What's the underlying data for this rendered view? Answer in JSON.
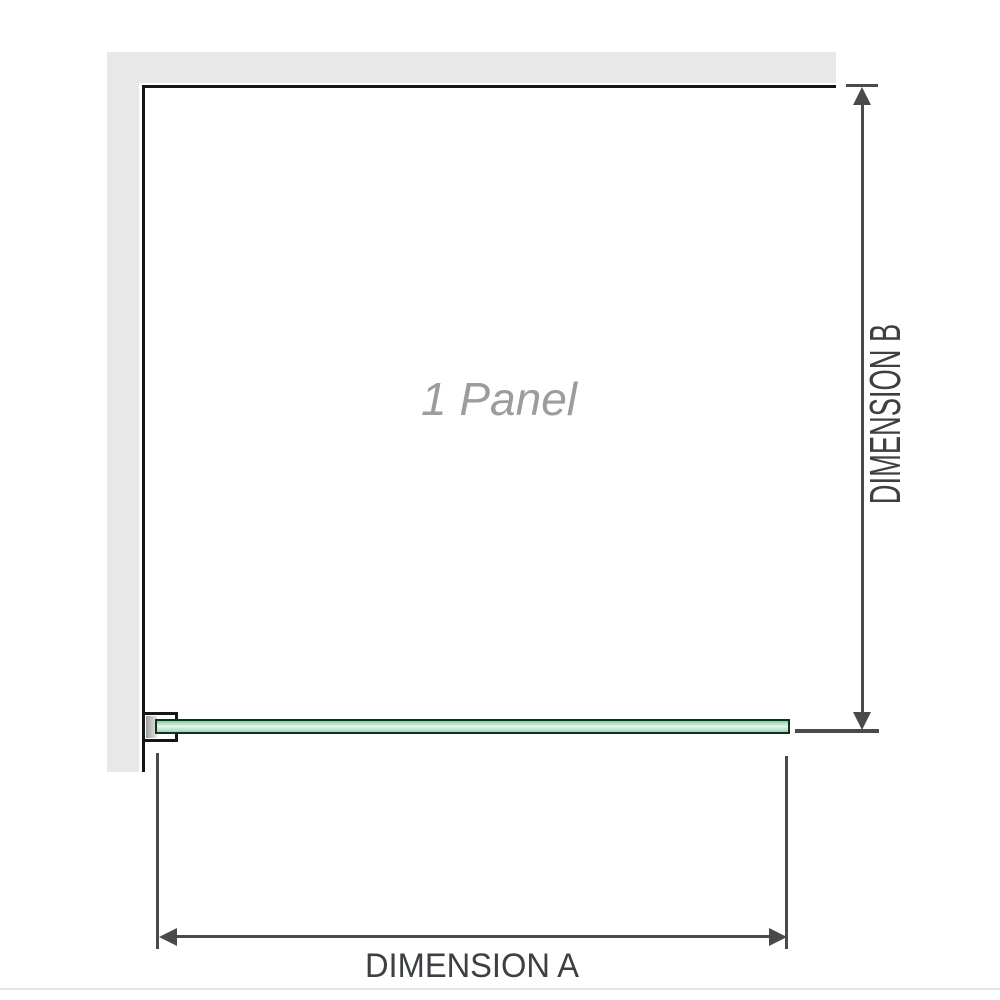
{
  "diagram": {
    "panel_label": "1 Panel",
    "dimension_a": {
      "label": "DIMENSION A"
    },
    "dimension_b": {
      "label": "DIMENSION B"
    }
  },
  "icons": {
    "dim-b-arrow-up-icon": "css-triangle-up",
    "dim-b-arrow-down-icon": "css-triangle-down",
    "dim-a-arrow-left-icon": "css-triangle-left",
    "dim-a-arrow-right-icon": "css-triangle-right"
  },
  "colors": {
    "background": "#ffffff",
    "wall": "#e8e8e8",
    "outline": "#161616",
    "dimension_lines": "#4a4a4a",
    "dimension_text": "#3d4043",
    "panel_label_text": "#9c9c9c",
    "glass_border": "#14311e",
    "glass_fill_dark": "#85cba2",
    "glass_fill_light": "#e7f7ee",
    "glass_fill_mid": "#9cd7b8",
    "footer_rule": "#e8e5e0"
  }
}
